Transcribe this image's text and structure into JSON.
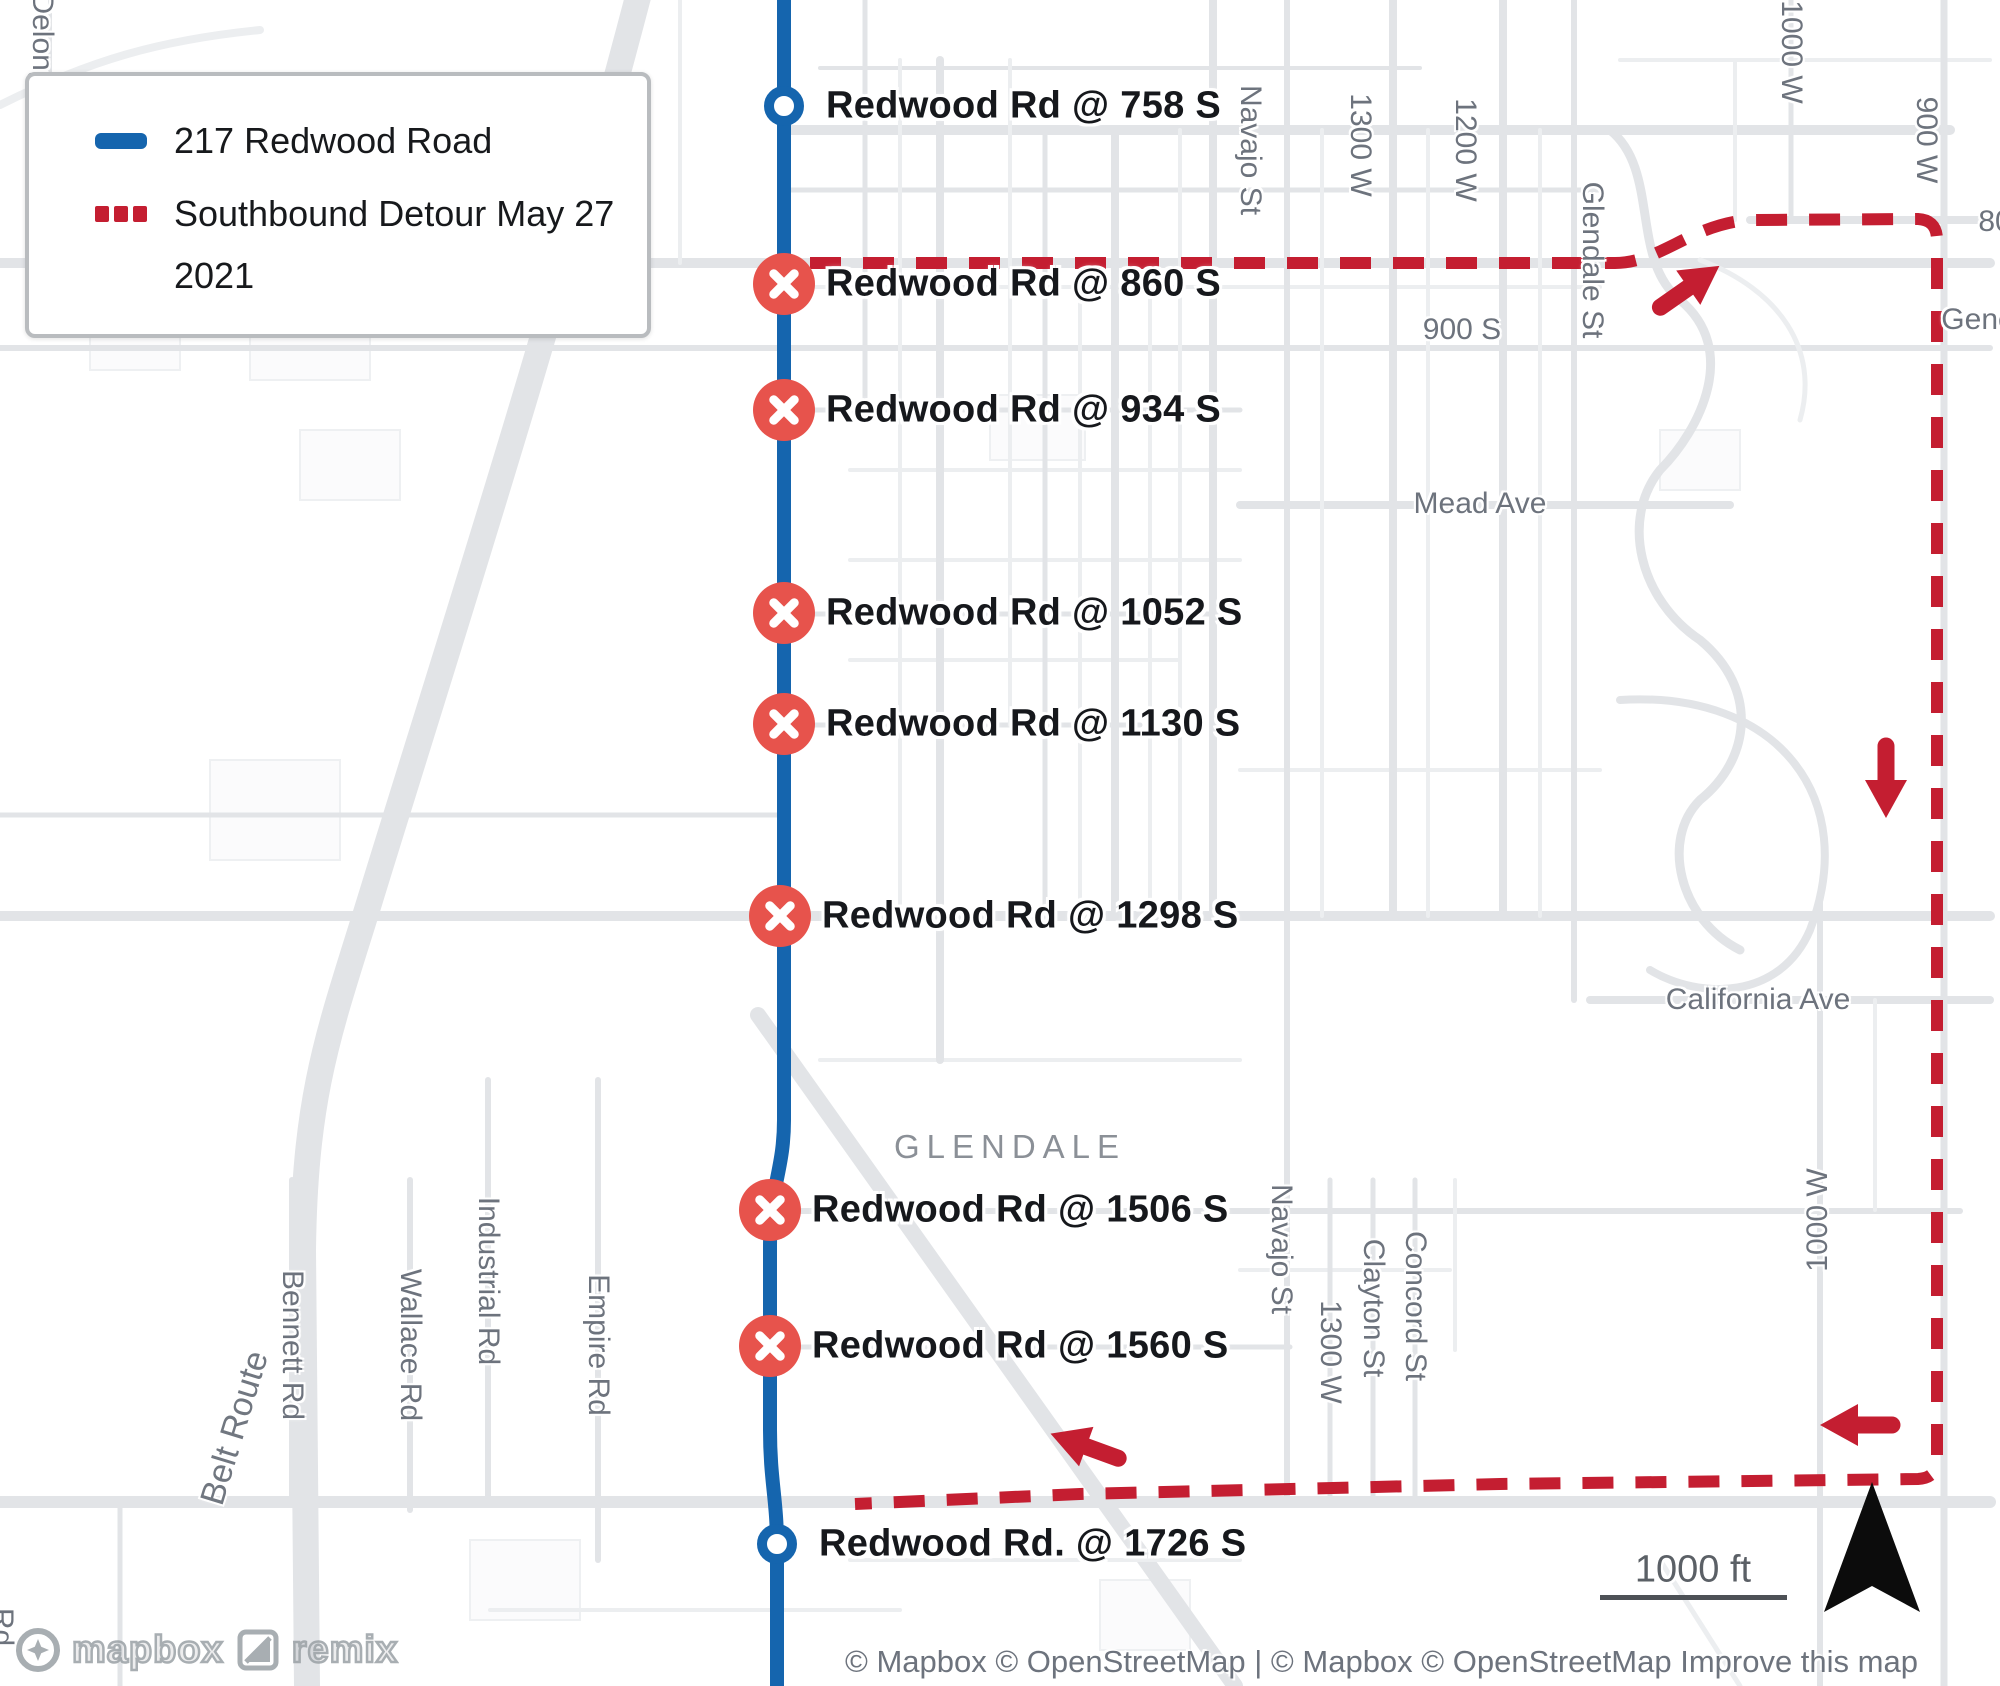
{
  "legend": {
    "route_label": "217 Redwood Road",
    "detour_label_line1": "Southbound Detour May 27",
    "detour_label_line2": "2021"
  },
  "stops": [
    {
      "label": "Redwood Rd @ 758 S",
      "type": "open"
    },
    {
      "label": "Redwood Rd @ 860 S",
      "type": "closed"
    },
    {
      "label": "Redwood Rd @ 934 S",
      "type": "closed"
    },
    {
      "label": "Redwood Rd @ 1052 S",
      "type": "closed"
    },
    {
      "label": "Redwood Rd @ 1130 S",
      "type": "closed"
    },
    {
      "label": "Redwood Rd @ 1298 S",
      "type": "closed"
    },
    {
      "label": "Redwood Rd @ 1506 S",
      "type": "closed"
    },
    {
      "label": "Redwood Rd @ 1560 S",
      "type": "closed"
    },
    {
      "label": "Redwood Rd. @ 1726 S",
      "type": "open"
    }
  ],
  "city_label": "GLENDALE",
  "street_labels": {
    "delong": "Delong",
    "navajo_top": "Navajo St",
    "w1300_top": "1300 W",
    "w1200": "1200 W",
    "glendale_st": "Glendale St",
    "s900": "900 S",
    "w900": "900 W",
    "w1000_top": "1000 W",
    "s800_partial": "80",
    "gene_partial": "Gene",
    "mead_ave": "Mead Ave",
    "california_ave": "California Ave",
    "navajo_bottom": "Navajo St",
    "concord": "Concord St",
    "clayton": "Clayton St",
    "w1300_bottom": "1300 W",
    "w1000_bottom": "1000 W",
    "bennett": "Bennett Rd",
    "wallace": "Wallace Rd",
    "industrial": "Industrial Rd",
    "empire": "Empire Rd",
    "belt_route": "Belt Route",
    "rd_partial": "Rd"
  },
  "scale": {
    "distance_label": "1000 ft"
  },
  "attribution": {
    "text": "© Mapbox © OpenStreetMap | © Mapbox © OpenStreetMap ",
    "improve_link": "Improve this map"
  },
  "logos": {
    "mapbox": "mapbox",
    "remix": "remix"
  },
  "colors": {
    "route_blue": "#1565ae",
    "detour_red": "#c41e31",
    "stop_closed_fill": "#e7534c",
    "stop_open_ring": "#1565ae",
    "label_dark": "#16181c",
    "street_gray": "#6d737d",
    "road_gray": "#e2e4e7",
    "north_arrow": "#0c0c0c"
  }
}
